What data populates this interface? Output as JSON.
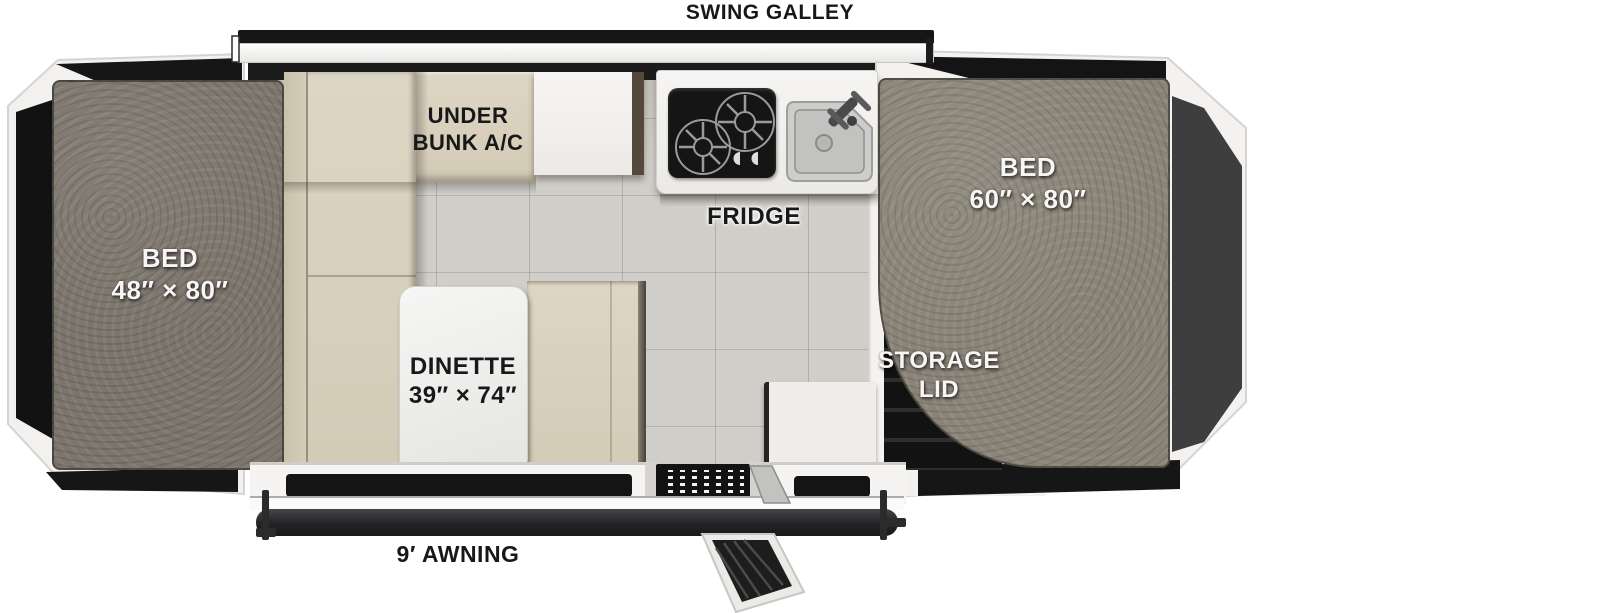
{
  "diagram_type": "rv-popup-camper-floorplan",
  "labels": {
    "swing_galley": "SWING GALLEY",
    "under_bunk_ac": [
      "UNDER",
      "BUNK A/C"
    ],
    "fridge": "FRIDGE",
    "bed_left": [
      "BED",
      "48″ × 80″"
    ],
    "bed_right": [
      "BED",
      "60″ × 80″"
    ],
    "dinette": [
      "DINETTE",
      "39″ × 74″"
    ],
    "storage_lid": [
      "STORAGE",
      "LID"
    ],
    "awning": "9′ AWNING"
  },
  "colors": {
    "canvas_black": "#151515",
    "canvas_gray": "#3e3e3e",
    "mattress_gray": "#837d73",
    "cushion_tan": "#d8d0bd",
    "floor_tile": "#d0cec9",
    "counter_white": "#f2f1ef",
    "label_black": "#181818",
    "label_white": "#f7f6f4"
  }
}
